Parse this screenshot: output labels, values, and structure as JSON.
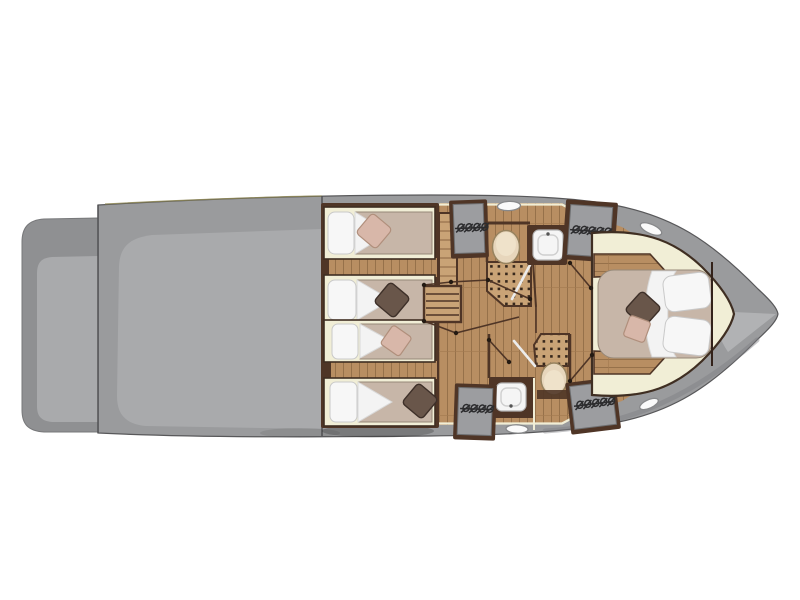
{
  "diagram": {
    "name": "yacht-lower-deck-floorplan",
    "type": "boat floor plan, top-down view",
    "orientation": "bow-right, stern-left",
    "areas": [
      {
        "id": "swim-platform",
        "label": "swim platform"
      },
      {
        "id": "cockpit-deck",
        "label": "cockpit deck"
      },
      {
        "id": "guest-cabin-aft",
        "label": "twin guest cabin aft",
        "berths": 2
      },
      {
        "id": "guest-cabin-mid",
        "label": "twin guest cabin mid",
        "berths": 2
      },
      {
        "id": "head-top",
        "label": "head with toilet, washbasin, shower"
      },
      {
        "id": "head-bottom",
        "label": "head with toilet, washbasin, shower"
      },
      {
        "id": "companionway",
        "label": "companionway stairs"
      },
      {
        "id": "corridor",
        "label": "corridor with cabin doors"
      },
      {
        "id": "master-cabin",
        "label": "master cabin bow",
        "berths": 1
      }
    ],
    "fixtures": {
      "single_berths": 4,
      "double_berths": 1,
      "toilets": 2,
      "washbasins": 2,
      "shower_floors": 2,
      "hanging_lockers": 4,
      "deck_hatches": 4,
      "stair_flights": 2,
      "door_swings": 6
    }
  },
  "colors": {
    "page_bg": "#ffffff",
    "hull": "#9a9b9d",
    "hull_light": "#a9aaac",
    "hull_deep": "#7e7f82",
    "hull_highlight": "#b4b5b7",
    "platform": "#8f9092",
    "outline": "#58585a",
    "wood": "#b88e62",
    "wood_line": "#96714a",
    "wood_light": "#c9a376",
    "walnut": "#4f3526",
    "cream": "#f1eed6",
    "mattress": "#c7b6a8",
    "mattress_line": "#968878",
    "pillow": "#f7f7f7",
    "pillow_line": "#c9c9c9",
    "cushion_dark": "#69564a",
    "cushion_pink": "#d8b7a9",
    "porcelain": "#f5f5f5",
    "toilet": "#e7d6bc",
    "locker": "#9c9da0",
    "glass": "#ececec"
  }
}
